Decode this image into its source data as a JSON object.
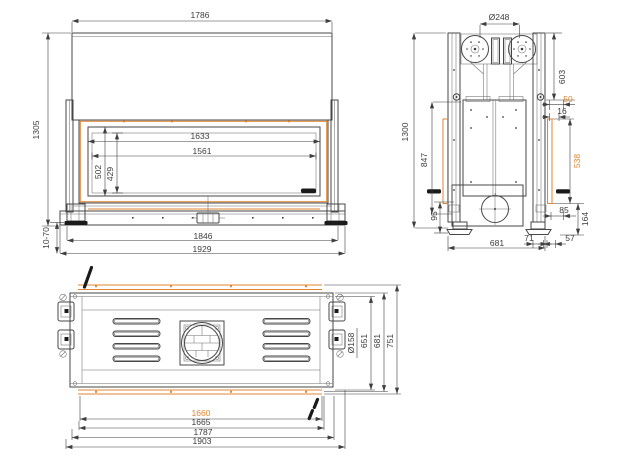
{
  "views": {
    "front": {
      "dims": {
        "top_width": "1786",
        "height": "1305",
        "glass_outer_width": "1633",
        "glass_inner_width": "1561",
        "glass_outer_height": "502",
        "glass_inner_height": "429",
        "base_width": "1846",
        "overall_width": "1929",
        "leg_range": "10-70"
      }
    },
    "side": {
      "dims": {
        "flue_diameter": "Ø248",
        "height": "1300",
        "opening_height": "847",
        "top_section": "603",
        "front_offset": "50",
        "frame_offset": "16",
        "glass_strip": "538",
        "rear_offset": "85",
        "base_height": "164",
        "foot_height": "95",
        "offset_71": "71",
        "offset_57": "57",
        "depth": "681"
      }
    },
    "bottom": {
      "dims": {
        "outlet_diameter": "Ø158",
        "inner_depth": "651",
        "mid_depth": "681",
        "outer_depth": "751",
        "glass_width": "1660",
        "opening_width": "1665",
        "body_width": "1787",
        "overall_width": "1903"
      }
    }
  },
  "colors": {
    "line": "#474747",
    "accent": "#e0862f",
    "text": "#3b3b3b"
  }
}
